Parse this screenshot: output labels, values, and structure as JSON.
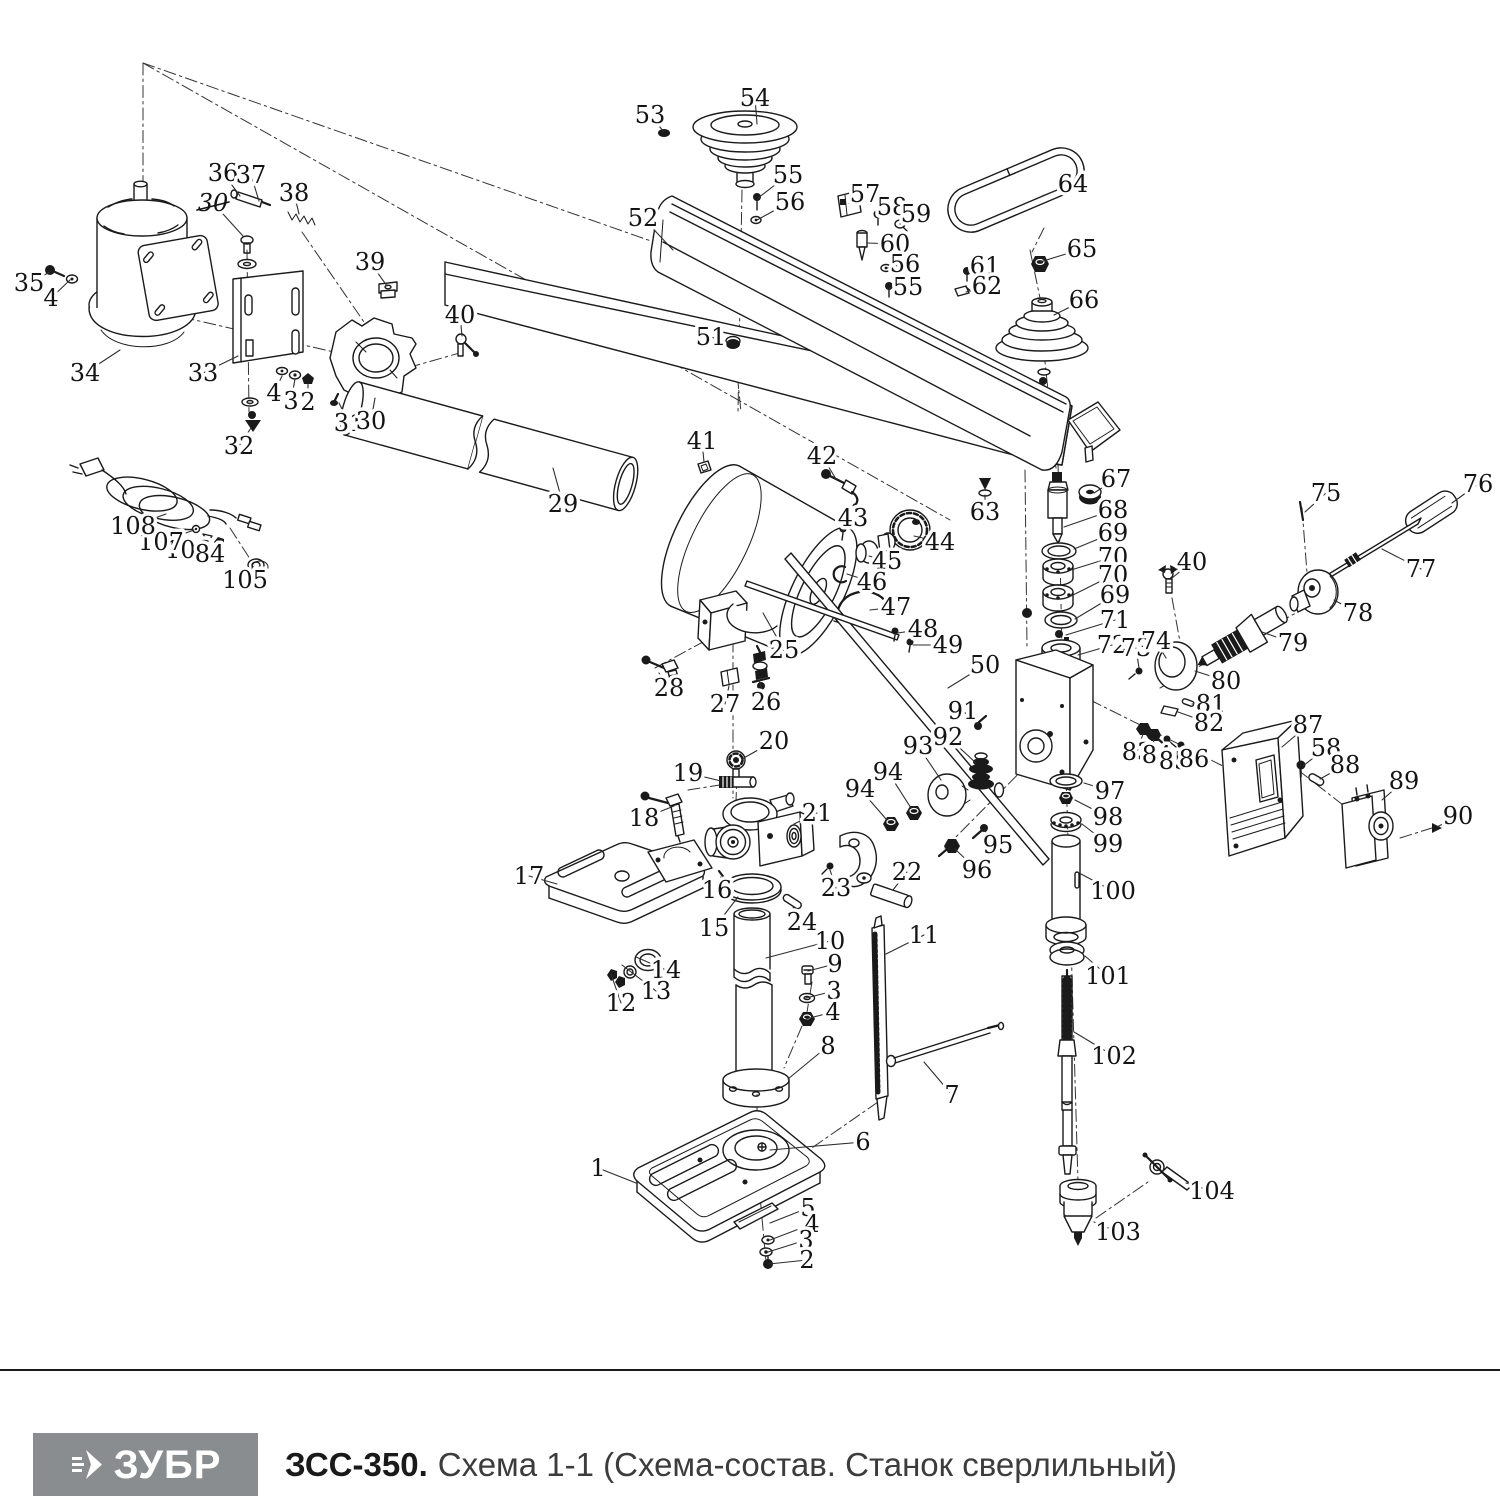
{
  "footer": {
    "brand": "ЗУБР",
    "model": "ЗСС-350.",
    "scheme_title": "Схема 1-1 (Схема-состав. Станок сверлильный)"
  },
  "colors": {
    "line": "#1a1a1a",
    "label": "#141414",
    "leader": "#2e2e2e",
    "logo_bg": "#8a8d8f",
    "logo_text": "#ffffff",
    "title": "#1a1a1a",
    "subtitle": "#3c3c3c",
    "rule": "#1b1b1b",
    "bg": "#ffffff"
  },
  "diagram": {
    "labels": [
      {
        "t": "53",
        "x": 650,
        "y": 115,
        "tx": 664,
        "ty": 132
      },
      {
        "t": "54",
        "x": 755,
        "y": 98,
        "tx": 757,
        "ty": 124
      },
      {
        "t": "55",
        "x": 788,
        "y": 175,
        "tx": 758,
        "ty": 198
      },
      {
        "t": "56",
        "x": 790,
        "y": 202,
        "tx": 757,
        "ty": 220
      },
      {
        "t": "52",
        "x": 643,
        "y": 218,
        "tx": 673,
        "ty": 250
      },
      {
        "t": "57",
        "x": 865,
        "y": 194,
        "tx": 849,
        "ty": 203
      },
      {
        "t": "58",
        "x": 892,
        "y": 207,
        "tx": 878,
        "ty": 215
      },
      {
        "t": "59",
        "x": 916,
        "y": 214,
        "tx": 900,
        "ty": 224
      },
      {
        "t": "60",
        "x": 895,
        "y": 244,
        "tx": 868,
        "ty": 243
      },
      {
        "t": "56",
        "x": 905,
        "y": 264,
        "tx": 887,
        "ty": 268
      },
      {
        "t": "55",
        "x": 908,
        "y": 287,
        "tx": 889,
        "ty": 288
      },
      {
        "t": "61",
        "x": 985,
        "y": 266,
        "tx": 968,
        "ty": 272
      },
      {
        "t": "62",
        "x": 987,
        "y": 286,
        "tx": 966,
        "ty": 292
      },
      {
        "t": "64",
        "x": 1073,
        "y": 184,
        "tx": 1042,
        "ty": 196
      },
      {
        "t": "65",
        "x": 1082,
        "y": 249,
        "tx": 1040,
        "ty": 262
      },
      {
        "t": "66",
        "x": 1084,
        "y": 300,
        "tx": 1054,
        "ty": 315
      },
      {
        "t": "51",
        "x": 711,
        "y": 337,
        "tx": 730,
        "ty": 343
      },
      {
        "t": "36",
        "x": 223,
        "y": 173,
        "tx": 240,
        "ty": 196
      },
      {
        "t": "37",
        "x": 251,
        "y": 175,
        "tx": 259,
        "ty": 201
      },
      {
        "t": "38",
        "x": 294,
        "y": 193,
        "tx": 299,
        "ty": 214
      },
      {
        "t": "30",
        "x": 213,
        "y": 203,
        "tx": 243,
        "ty": 236,
        "struck": true
      },
      {
        "t": "39",
        "x": 370,
        "y": 262,
        "tx": 387,
        "ty": 286
      },
      {
        "t": "35",
        "x": 29,
        "y": 283,
        "tx": 50,
        "ty": 272
      },
      {
        "t": "4",
        "x": 51,
        "y": 298,
        "tx": 70,
        "ty": 280
      },
      {
        "t": "34",
        "x": 85,
        "y": 373,
        "tx": 120,
        "ty": 350
      },
      {
        "t": "33",
        "x": 203,
        "y": 373,
        "tx": 238,
        "ty": 356
      },
      {
        "t": "4",
        "x": 274,
        "y": 393,
        "tx": 282,
        "ty": 376
      },
      {
        "t": "3",
        "x": 291,
        "y": 401,
        "tx": 295,
        "ty": 379
      },
      {
        "t": "2",
        "x": 308,
        "y": 402,
        "tx": 308,
        "ty": 384
      },
      {
        "t": "32",
        "x": 239,
        "y": 446,
        "tx": 251,
        "ty": 428
      },
      {
        "t": "31",
        "x": 349,
        "y": 423,
        "tx": 339,
        "ty": 403
      },
      {
        "t": "30",
        "x": 371,
        "y": 421,
        "tx": 375,
        "ty": 398
      },
      {
        "t": "40",
        "x": 460,
        "y": 315,
        "tx": 462,
        "ty": 336
      },
      {
        "t": "29",
        "x": 563,
        "y": 504,
        "tx": 553,
        "ty": 468
      },
      {
        "t": "41",
        "x": 702,
        "y": 441,
        "tx": 704,
        "ty": 462
      },
      {
        "t": "42",
        "x": 822,
        "y": 456,
        "tx": 836,
        "ty": 479
      },
      {
        "t": "43",
        "x": 853,
        "y": 518,
        "tx": 843,
        "ty": 531
      },
      {
        "t": "44",
        "x": 940,
        "y": 542,
        "tx": 914,
        "ty": 536
      },
      {
        "t": "45",
        "x": 887,
        "y": 561,
        "tx": 869,
        "ty": 556
      },
      {
        "t": "46",
        "x": 872,
        "y": 582,
        "tx": 847,
        "ty": 574
      },
      {
        "t": "47",
        "x": 896,
        "y": 607,
        "tx": 870,
        "ty": 610
      },
      {
        "t": "48",
        "x": 923,
        "y": 629,
        "tx": 898,
        "ty": 633
      },
      {
        "t": "49",
        "x": 948,
        "y": 645,
        "tx": 913,
        "ty": 645
      },
      {
        "t": "50",
        "x": 985,
        "y": 665,
        "tx": 948,
        "ty": 688
      },
      {
        "t": "63",
        "x": 985,
        "y": 512,
        "tx": 985,
        "ty": 495
      },
      {
        "t": "67",
        "x": 1116,
        "y": 479,
        "tx": 1094,
        "ty": 493
      },
      {
        "t": "68",
        "x": 1113,
        "y": 510,
        "tx": 1064,
        "ty": 527
      },
      {
        "t": "69",
        "x": 1113,
        "y": 533,
        "tx": 1074,
        "ty": 549
      },
      {
        "t": "70",
        "x": 1113,
        "y": 557,
        "tx": 1071,
        "ty": 570
      },
      {
        "t": "70",
        "x": 1113,
        "y": 575,
        "tx": 1071,
        "ty": 596
      },
      {
        "t": "69",
        "x": 1115,
        "y": 595,
        "tx": 1075,
        "ty": 619
      },
      {
        "t": "71",
        "x": 1115,
        "y": 620,
        "tx": 1066,
        "ty": 635
      },
      {
        "t": "72",
        "x": 1112,
        "y": 645,
        "tx": 1078,
        "ty": 655
      },
      {
        "t": "73",
        "x": 1136,
        "y": 648,
        "tx": 1139,
        "ty": 668
      },
      {
        "t": "74",
        "x": 1156,
        "y": 641,
        "tx": 1166,
        "ty": 658
      },
      {
        "t": "25",
        "x": 784,
        "y": 650,
        "tx": 763,
        "ty": 613
      },
      {
        "t": "26",
        "x": 766,
        "y": 702,
        "tx": 759,
        "ty": 680
      },
      {
        "t": "27",
        "x": 725,
        "y": 704,
        "tx": 729,
        "ty": 686
      },
      {
        "t": "28",
        "x": 669,
        "y": 688,
        "tx": 659,
        "ty": 673
      },
      {
        "t": "91",
        "x": 963,
        "y": 711,
        "tx": 978,
        "ty": 724
      },
      {
        "t": "92",
        "x": 948,
        "y": 737,
        "tx": 976,
        "ty": 763
      },
      {
        "t": "93",
        "x": 918,
        "y": 746,
        "tx": 941,
        "ty": 780
      },
      {
        "t": "94",
        "x": 888,
        "y": 772,
        "tx": 911,
        "ty": 808
      },
      {
        "t": "94",
        "x": 860,
        "y": 789,
        "tx": 886,
        "ty": 819
      },
      {
        "t": "95",
        "x": 998,
        "y": 845,
        "tx": 984,
        "ty": 830
      },
      {
        "t": "96",
        "x": 977,
        "y": 870,
        "tx": 955,
        "ty": 849
      },
      {
        "t": "97",
        "x": 1110,
        "y": 791,
        "tx": 1084,
        "ty": 783
      },
      {
        "t": "98",
        "x": 1108,
        "y": 817,
        "tx": 1075,
        "ty": 800
      },
      {
        "t": "99",
        "x": 1108,
        "y": 844,
        "tx": 1082,
        "ty": 824
      },
      {
        "t": "100",
        "x": 1113,
        "y": 891,
        "tx": 1081,
        "ty": 874
      },
      {
        "t": "101",
        "x": 1108,
        "y": 976,
        "tx": 1085,
        "ty": 956
      },
      {
        "t": "102",
        "x": 1114,
        "y": 1056,
        "tx": 1074,
        "ty": 1032
      },
      {
        "t": "103",
        "x": 1118,
        "y": 1232,
        "tx": 1094,
        "ty": 1222
      },
      {
        "t": "104",
        "x": 1212,
        "y": 1191,
        "tx": 1186,
        "ty": 1183
      },
      {
        "t": "75",
        "x": 1326,
        "y": 493,
        "tx": 1305,
        "ty": 512
      },
      {
        "t": "76",
        "x": 1478,
        "y": 484,
        "tx": 1452,
        "ty": 503
      },
      {
        "t": "77",
        "x": 1421,
        "y": 569,
        "tx": 1382,
        "ty": 549
      },
      {
        "t": "78",
        "x": 1358,
        "y": 613,
        "tx": 1334,
        "ty": 600
      },
      {
        "t": "79",
        "x": 1293,
        "y": 643,
        "tx": 1262,
        "ty": 632
      },
      {
        "t": "80",
        "x": 1226,
        "y": 681,
        "tx": 1195,
        "ty": 671
      },
      {
        "t": "40",
        "x": 1192,
        "y": 562,
        "tx": 1172,
        "ty": 578
      },
      {
        "t": "81",
        "x": 1211,
        "y": 704,
        "tx": 1192,
        "ty": 704
      },
      {
        "t": "82",
        "x": 1209,
        "y": 723,
        "tx": 1178,
        "ty": 712
      },
      {
        "t": "83",
        "x": 1137,
        "y": 752,
        "tx": 1143,
        "ty": 734
      },
      {
        "t": "84",
        "x": 1157,
        "y": 755,
        "tx": 1153,
        "ty": 739
      },
      {
        "t": "85",
        "x": 1174,
        "y": 761,
        "tx": 1168,
        "ty": 743
      },
      {
        "t": "86",
        "x": 1194,
        "y": 759,
        "tx": 1182,
        "ty": 748
      },
      {
        "t": "87",
        "x": 1308,
        "y": 725,
        "tx": 1282,
        "ty": 747
      },
      {
        "t": "58",
        "x": 1326,
        "y": 748,
        "tx": 1303,
        "ty": 766
      },
      {
        "t": "88",
        "x": 1345,
        "y": 765,
        "tx": 1320,
        "ty": 779
      },
      {
        "t": "89",
        "x": 1404,
        "y": 781,
        "tx": 1382,
        "ty": 800
      },
      {
        "t": "90",
        "x": 1458,
        "y": 816,
        "tx": 1437,
        "ty": 827
      },
      {
        "t": "20",
        "x": 774,
        "y": 741,
        "tx": 742,
        "ty": 759
      },
      {
        "t": "19",
        "x": 688,
        "y": 773,
        "tx": 721,
        "ty": 781
      },
      {
        "t": "18",
        "x": 644,
        "y": 818,
        "tx": 674,
        "ty": 806
      },
      {
        "t": "21",
        "x": 817,
        "y": 813,
        "tx": 794,
        "ty": 824
      },
      {
        "t": "17",
        "x": 529,
        "y": 876,
        "tx": 557,
        "ty": 884
      },
      {
        "t": "16",
        "x": 717,
        "y": 890,
        "tx": 721,
        "ty": 877
      },
      {
        "t": "15",
        "x": 714,
        "y": 928,
        "tx": 738,
        "ty": 897
      },
      {
        "t": "23",
        "x": 836,
        "y": 888,
        "tx": 830,
        "ty": 870
      },
      {
        "t": "22",
        "x": 907,
        "y": 872,
        "tx": 893,
        "ty": 890
      },
      {
        "t": "24",
        "x": 802,
        "y": 922,
        "tx": 793,
        "ty": 907
      },
      {
        "t": "14",
        "x": 666,
        "y": 970,
        "tx": 636,
        "ty": 957
      },
      {
        "t": "13",
        "x": 656,
        "y": 991,
        "tx": 622,
        "ty": 965
      },
      {
        "t": "12",
        "x": 621,
        "y": 1003,
        "tx": 611,
        "ty": 974
      },
      {
        "t": "10",
        "x": 830,
        "y": 941,
        "tx": 766,
        "ty": 958
      },
      {
        "t": "9",
        "x": 835,
        "y": 964,
        "tx": 808,
        "ty": 971
      },
      {
        "t": "3",
        "x": 834,
        "y": 991,
        "tx": 806,
        "ty": 998
      },
      {
        "t": "4",
        "x": 833,
        "y": 1012,
        "tx": 806,
        "ty": 1019
      },
      {
        "t": "11",
        "x": 924,
        "y": 935,
        "tx": 886,
        "ty": 954
      },
      {
        "t": "8",
        "x": 828,
        "y": 1046,
        "tx": 788,
        "ty": 1079
      },
      {
        "t": "7",
        "x": 952,
        "y": 1095,
        "tx": 924,
        "ty": 1062
      },
      {
        "t": "6",
        "x": 863,
        "y": 1142,
        "tx": 770,
        "ty": 1150
      },
      {
        "t": "1",
        "x": 598,
        "y": 1168,
        "tx": 636,
        "ty": 1183
      },
      {
        "t": "5",
        "x": 808,
        "y": 1208,
        "tx": 770,
        "ty": 1223
      },
      {
        "t": "4",
        "x": 812,
        "y": 1224,
        "tx": 770,
        "ty": 1240
      },
      {
        "t": "3",
        "x": 806,
        "y": 1240,
        "tx": 768,
        "ty": 1252
      },
      {
        "t": "2",
        "x": 807,
        "y": 1260,
        "tx": 769,
        "ty": 1264
      },
      {
        "t": "105",
        "x": 245,
        "y": 580,
        "tx": 254,
        "ty": 568
      },
      {
        "t": "106",
        "x": 188,
        "y": 550,
        "tx": 206,
        "ty": 539
      },
      {
        "t": "107",
        "x": 161,
        "y": 542,
        "tx": 194,
        "ty": 530
      },
      {
        "t": "84",
        "x": 210,
        "y": 554,
        "tx": 218,
        "ty": 544
      },
      {
        "t": "108",
        "x": 133,
        "y": 526,
        "tx": 166,
        "ty": 514
      }
    ]
  }
}
